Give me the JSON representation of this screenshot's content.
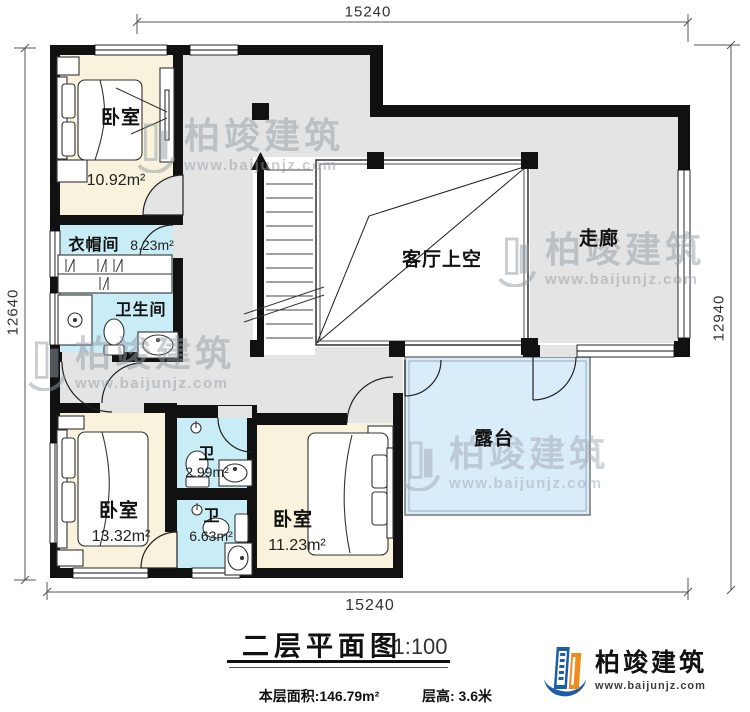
{
  "dimensions": {
    "top": "15240",
    "bottom": "15240",
    "left": "12640",
    "right": "12940"
  },
  "rooms": {
    "bedroom_tl": {
      "label": "卧室",
      "area": "10.92m²"
    },
    "cloakroom": {
      "label": "衣帽间",
      "area": "8.23m²"
    },
    "bathroom": {
      "label": "卫生间"
    },
    "living_void": {
      "label": "客厅上空"
    },
    "corridor": {
      "label": "走廊"
    },
    "bedroom_bl": {
      "label": "卧室",
      "area": "13.32m²"
    },
    "wc_small": {
      "label": "卫",
      "area": "2.99m²"
    },
    "wc_large": {
      "label": "卫",
      "area": "6.63m²"
    },
    "bedroom_br": {
      "label": "卧室",
      "area": "11.23m²"
    },
    "terrace": {
      "label": "露台"
    }
  },
  "title": {
    "text": "二层平面图",
    "scale": "1:100"
  },
  "footer": {
    "floor_area": "本层面积:146.79m²",
    "floor_height": "层高: 3.6米"
  },
  "brand": {
    "name": "柏竣建筑",
    "url": "www.baijunjz.com"
  },
  "colors": {
    "bedroom": "#f9f2dc",
    "wet_room": "#c9edf7",
    "circulation": "#e4e4e4",
    "terrace": "#d9ecf9",
    "wall": "#111111",
    "logo_blue": "#1b5ea6",
    "logo_orange": "#f08c1e"
  }
}
